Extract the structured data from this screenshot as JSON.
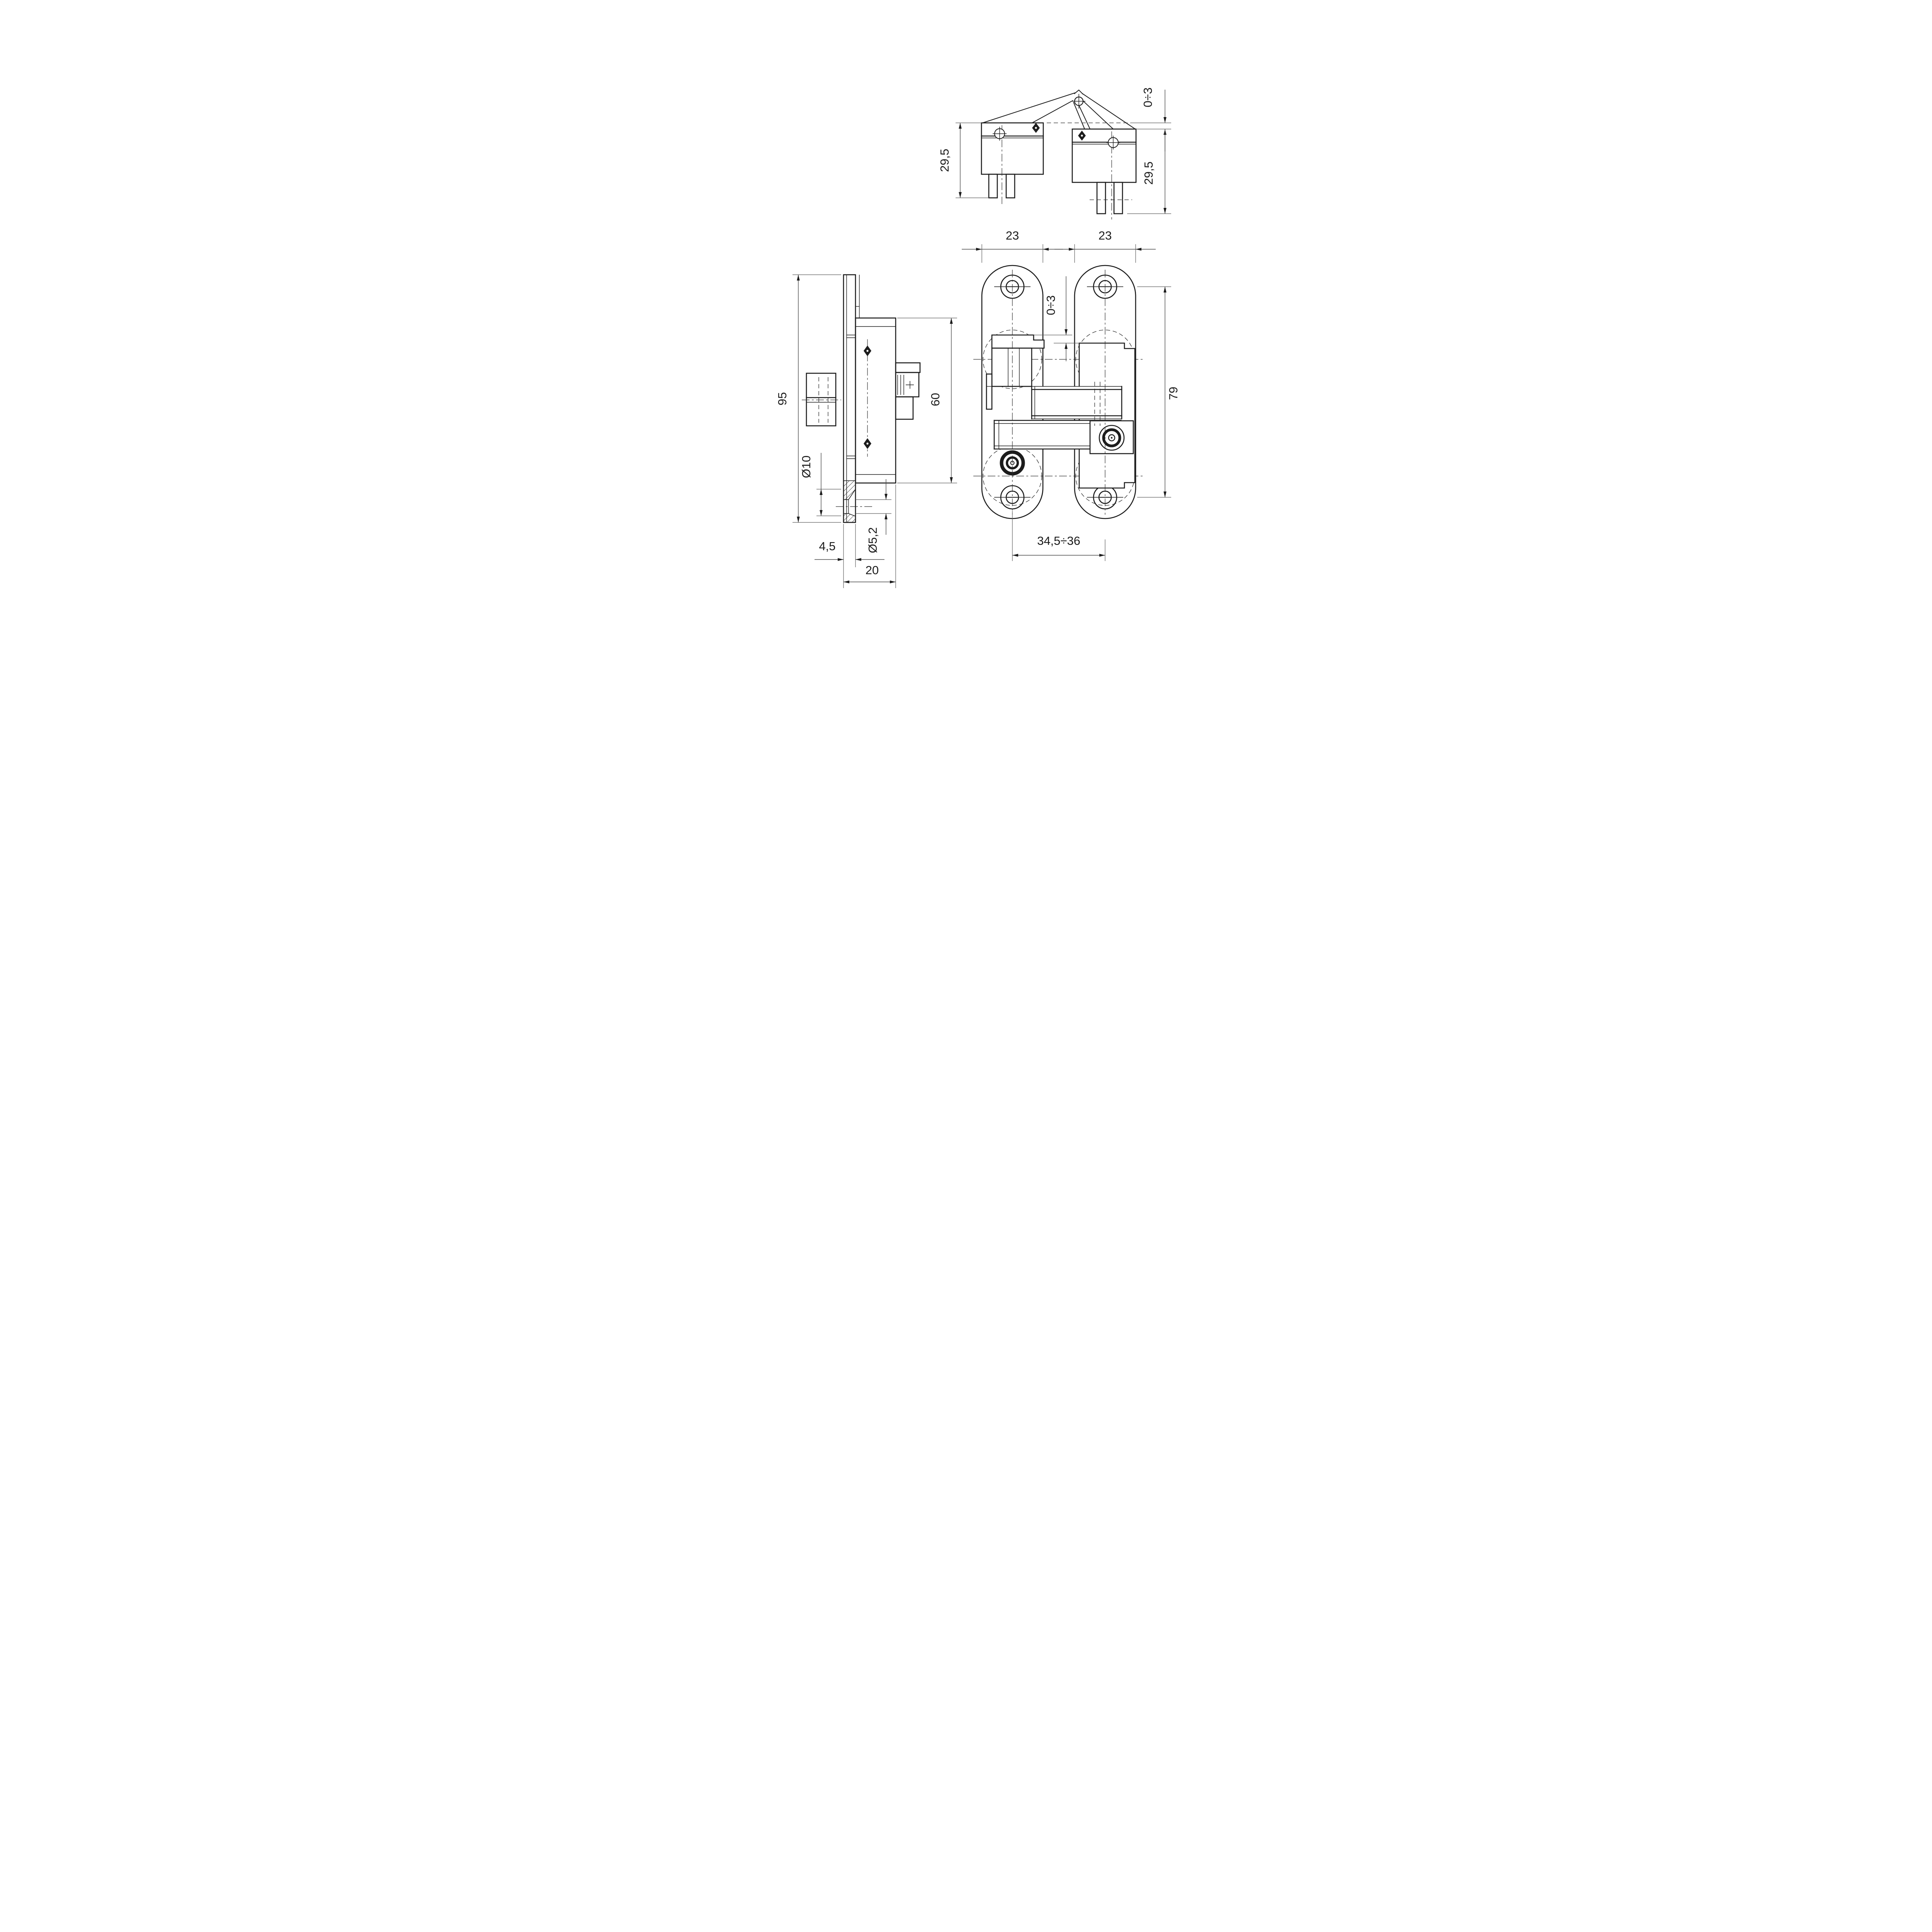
{
  "drawing": {
    "background_color": "#ffffff",
    "line_color": "#1c1c1c",
    "dim_color": "#4a4a4a",
    "top_view": {
      "offset_dim": "0÷3",
      "left_height_dim": "29,5",
      "right_height_dim": "29,5"
    },
    "front_view": {
      "left_plate_width_dim": "23",
      "right_plate_width_dim": "23",
      "center_gap_dim": "0÷3",
      "hole_spacing_dim": "79",
      "mounting_distance_dim": "34,5÷36"
    },
    "side_view": {
      "overall_length_dim": "95",
      "body_length_dim": "60",
      "countersink_diameter_dim": "Ø10",
      "hole_diameter_dim": "Ø5,2",
      "plate_thickness_dim": "4,5",
      "body_depth_dim": "20"
    }
  }
}
